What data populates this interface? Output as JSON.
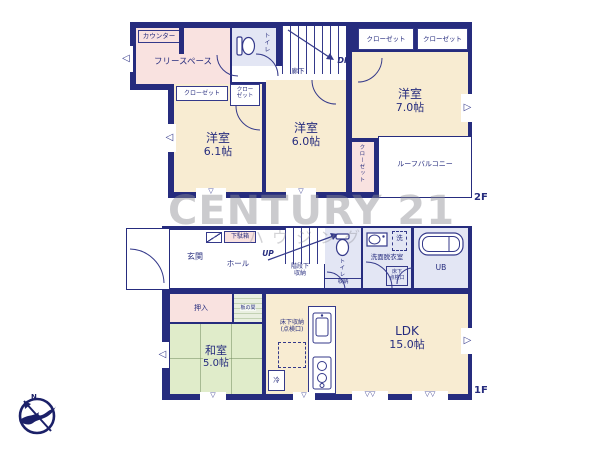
{
  "colors": {
    "wall": "#262c7e",
    "room_cream": "#f8ecd2",
    "closet_pink": "#f9e2e0",
    "tatami_green": "#e0ecca",
    "wet_blue": "#e3e6f4",
    "watermark_gray": "#8c8c92"
  },
  "watermark": {
    "line1": "CENTURY 21",
    "line2": "ハウジング"
  },
  "compass": {
    "north": "N"
  },
  "icons": {
    "window_down": "▽",
    "window_left": "◁",
    "window_right": "▷"
  },
  "floor2": {
    "floor_label": "2F",
    "counter": "カウンター",
    "free_space": "フリースペース",
    "toilet": "トイレ",
    "corridor": "廊下",
    "stairs_down": "DN",
    "closet_a": "クローゼット",
    "closet_b": "クローゼット",
    "closet_c": "クローゼット",
    "closet_d_line1": "クロー",
    "closet_d_line2": "ゼット",
    "closet_vertical": "クローゼット",
    "room_70": {
      "name": "洋室",
      "size": "7.0帖"
    },
    "room_61": {
      "name": "洋室",
      "size": "6.1帖"
    },
    "room_60": {
      "name": "洋室",
      "size": "6.0帖"
    },
    "roof_balcony": "ルーフバルコニー"
  },
  "floor1": {
    "floor_label": "1F",
    "entrance": "玄関",
    "shoe_box": "下駄箱",
    "hall": "ホール",
    "stairs_up": "UP",
    "under_stair_storage_line1": "階段下",
    "under_stair_storage_line2": "収納",
    "toilet": "トイレ",
    "toilet_storage": "収納",
    "washroom": "洗面脱衣室",
    "laundry": "洗",
    "washroom_hatch_line1": "床下",
    "washroom_hatch_line2": "点検口",
    "unit_bath": "UB",
    "oshiire": "押入",
    "itanoma": "板の間",
    "washitsu": {
      "name": "和室",
      "size": "5.0帖"
    },
    "underfloor_storage_line1": "床下収納",
    "underfloor_storage_line2": "(点検口)",
    "fridge": "冷",
    "ldk": {
      "name": "LDK",
      "size": "15.0帖"
    }
  }
}
